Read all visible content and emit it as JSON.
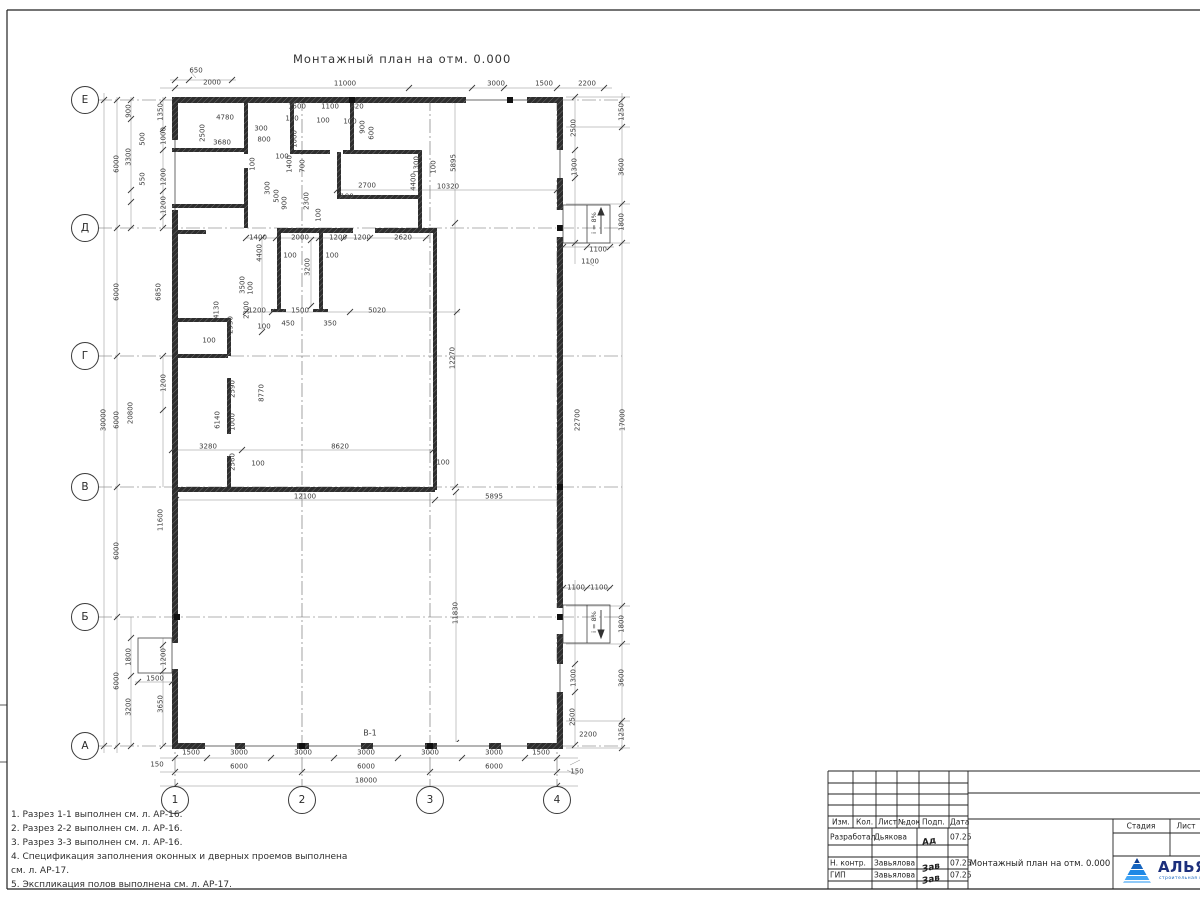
{
  "sheet": {
    "title": "Монтажный план на отм. 0.000"
  },
  "labels": {
    "wall_mark": "В-1",
    "ramp_slope": "i = 8%"
  },
  "axes": {
    "rows": [
      [
        "Е",
        100
      ],
      [
        "Д",
        228
      ],
      [
        "Г",
        356
      ],
      [
        "В",
        487
      ],
      [
        "Б",
        617
      ],
      [
        "А",
        746
      ]
    ],
    "cols": [
      [
        "1",
        175
      ],
      [
        "2",
        302
      ],
      [
        "3",
        430
      ],
      [
        "4",
        557
      ]
    ]
  },
  "dims": [
    [
      "650",
      196,
      71,
      0
    ],
    [
      "2000",
      212,
      83,
      0
    ],
    [
      "11000",
      345,
      84,
      0
    ],
    [
      "3000",
      496,
      84,
      0
    ],
    [
      "1500",
      544,
      84,
      0
    ],
    [
      "2200",
      587,
      84,
      0
    ],
    [
      "1500",
      191,
      753,
      0
    ],
    [
      "3000",
      239,
      753,
      0
    ],
    [
      "3000",
      303,
      753,
      0
    ],
    [
      "3000",
      366,
      753,
      0
    ],
    [
      "3000",
      430,
      753,
      0
    ],
    [
      "3000",
      494,
      753,
      0
    ],
    [
      "1500",
      541,
      753,
      0
    ],
    [
      "150",
      157,
      765,
      0
    ],
    [
      "150",
      577,
      772,
      0
    ],
    [
      "6000",
      239,
      767,
      0
    ],
    [
      "6000",
      366,
      767,
      0
    ],
    [
      "6000",
      494,
      767,
      0
    ],
    [
      "18000",
      366,
      781,
      0
    ],
    [
      "30000",
      104,
      420,
      1
    ],
    [
      "6000",
      117,
      164,
      1
    ],
    [
      "6000",
      117,
      292,
      1
    ],
    [
      "6000",
      117,
      420,
      1
    ],
    [
      "6000",
      117,
      551,
      1
    ],
    [
      "6000",
      117,
      681,
      1
    ],
    [
      "900",
      129,
      111,
      1
    ],
    [
      "3300",
      129,
      157,
      1
    ],
    [
      "550",
      143,
      179,
      1
    ],
    [
      "500",
      143,
      139,
      1
    ],
    [
      "1350",
      161,
      112,
      1
    ],
    [
      "1000",
      164,
      136,
      1
    ],
    [
      "1200",
      164,
      177,
      1
    ],
    [
      "1200",
      164,
      205,
      1
    ],
    [
      "6850",
      159,
      292,
      1
    ],
    [
      "20800",
      131,
      413,
      1
    ],
    [
      "11600",
      161,
      520,
      1
    ],
    [
      "1200",
      164,
      383,
      1
    ],
    [
      "1800",
      129,
      657,
      1
    ],
    [
      "1200",
      164,
      657,
      1
    ],
    [
      "1500",
      155,
      679,
      0
    ],
    [
      "3200",
      129,
      707,
      1
    ],
    [
      "3650",
      161,
      704,
      1
    ],
    [
      "1250",
      622,
      112,
      1
    ],
    [
      "2500",
      574,
      128,
      1
    ],
    [
      "1300",
      575,
      167,
      1
    ],
    [
      "3600",
      622,
      167,
      1
    ],
    [
      "1800",
      622,
      222,
      1
    ],
    [
      "1100",
      598,
      250,
      0
    ],
    [
      "1100",
      590,
      262,
      0
    ],
    [
      "22700",
      578,
      420,
      1
    ],
    [
      "17000",
      623,
      420,
      1
    ],
    [
      "1100",
      576,
      588,
      0
    ],
    [
      "1100",
      599,
      588,
      0
    ],
    [
      "1800",
      622,
      624,
      1
    ],
    [
      "1300",
      574,
      678,
      1
    ],
    [
      "3600",
      622,
      678,
      1
    ],
    [
      "2500",
      573,
      717,
      1
    ],
    [
      "2200",
      588,
      735,
      0
    ],
    [
      "1250",
      622,
      732,
      1
    ],
    [
      "4780",
      225,
      118,
      0
    ],
    [
      "2500",
      203,
      133,
      1
    ],
    [
      "3680",
      222,
      143,
      0
    ],
    [
      "300",
      261,
      129,
      0
    ],
    [
      "800",
      264,
      140,
      0
    ],
    [
      "1500",
      297,
      107,
      0
    ],
    [
      "100",
      292,
      119,
      0
    ],
    [
      "1100",
      330,
      107,
      0
    ],
    [
      "100",
      323,
      121,
      0
    ],
    [
      "820",
      357,
      107,
      0
    ],
    [
      "100",
      350,
      122,
      0
    ],
    [
      "900",
      363,
      127,
      1
    ],
    [
      "600",
      372,
      133,
      1
    ],
    [
      "1000",
      295,
      139,
      1
    ],
    [
      "100",
      282,
      157,
      0
    ],
    [
      "1400",
      290,
      164,
      1
    ],
    [
      "100",
      253,
      164,
      1
    ],
    [
      "700",
      303,
      166,
      1
    ],
    [
      "1300",
      417,
      165,
      1
    ],
    [
      "100",
      434,
      167,
      1
    ],
    [
      "2700",
      367,
      186,
      0
    ],
    [
      "4400",
      414,
      182,
      1
    ],
    [
      "500",
      277,
      196,
      1
    ],
    [
      "900",
      285,
      203,
      1
    ],
    [
      "300",
      268,
      188,
      1
    ],
    [
      "100",
      347,
      197,
      0
    ],
    [
      "2300",
      307,
      201,
      1
    ],
    [
      "100",
      319,
      215,
      1
    ],
    [
      "3500",
      243,
      285,
      1
    ],
    [
      "2300",
      247,
      310,
      1
    ],
    [
      "1400",
      258,
      238,
      0
    ],
    [
      "2000",
      300,
      238,
      0
    ],
    [
      "1200",
      338,
      238,
      0
    ],
    [
      "1200",
      362,
      238,
      0
    ],
    [
      "2620",
      403,
      238,
      0
    ],
    [
      "100",
      290,
      256,
      0
    ],
    [
      "100",
      332,
      256,
      0
    ],
    [
      "4400",
      260,
      253,
      1
    ],
    [
      "3200",
      308,
      267,
      1
    ],
    [
      "100",
      251,
      288,
      1
    ],
    [
      "10320",
      448,
      187,
      0
    ],
    [
      "5895",
      454,
      163,
      1
    ],
    [
      "1200",
      257,
      311,
      0
    ],
    [
      "1500",
      300,
      311,
      0
    ],
    [
      "5020",
      377,
      311,
      0
    ],
    [
      "450",
      288,
      324,
      0
    ],
    [
      "350",
      330,
      324,
      0
    ],
    [
      "100",
      264,
      327,
      0
    ],
    [
      "4130",
      217,
      310,
      1
    ],
    [
      "2930",
      231,
      325,
      1
    ],
    [
      "100",
      209,
      341,
      0
    ],
    [
      "12270",
      453,
      358,
      1
    ],
    [
      "2590",
      233,
      389,
      1
    ],
    [
      "8770",
      262,
      393,
      1
    ],
    [
      "6140",
      218,
      420,
      1
    ],
    [
      "1000",
      233,
      422,
      1
    ],
    [
      "3280",
      208,
      447,
      0
    ],
    [
      "8620",
      340,
      447,
      0
    ],
    [
      "2560",
      233,
      462,
      1
    ],
    [
      "100",
      258,
      464,
      0
    ],
    [
      "100",
      443,
      463,
      0
    ],
    [
      "12100",
      305,
      497,
      0
    ],
    [
      "5895",
      494,
      497,
      0
    ],
    [
      "11830",
      456,
      613,
      1
    ]
  ],
  "notes": [
    "1. Разрез 1-1 выполнен см. л. АР-16.",
    "2. Разрез 2-2 выполнен см. л. АР-16.",
    "3. Разрез 3-3 выполнен см. л. АР-16.",
    "4. Спецификация заполнения оконных и дверных проемов выполнена",
    "см. л. АР-17.",
    "5. Экспликация полов выполнена см. л. АР-17."
  ],
  "title_block": {
    "header_cols": [
      "Изм.",
      "Кол.",
      "Лист",
      "№док",
      "Подп.",
      "Дата"
    ],
    "rows": [
      {
        "role": "Разработал",
        "name": "Дьякова",
        "sign": "Ад",
        "date": "07.25"
      },
      {
        "role": "Н. контр.",
        "name": "Завьялова",
        "sign": "Зав",
        "date": "07.25"
      },
      {
        "role": "ГИП",
        "name": "Завьялова",
        "sign": "Зав",
        "date": "07.25"
      }
    ],
    "doc_title": "Монтажный план на отм. 0.000",
    "stage_cols": [
      "Стадия",
      "Лист",
      "Лист"
    ],
    "logo": {
      "name": "АЛЬЯНС",
      "tagline": "строительная компания"
    }
  },
  "colors": {
    "line": "#333333",
    "dim_line": "#8a8a8a",
    "wall": "#2e2e2e",
    "logo_navy": "#1c2f7c",
    "logo_blue": "#1565c0"
  }
}
